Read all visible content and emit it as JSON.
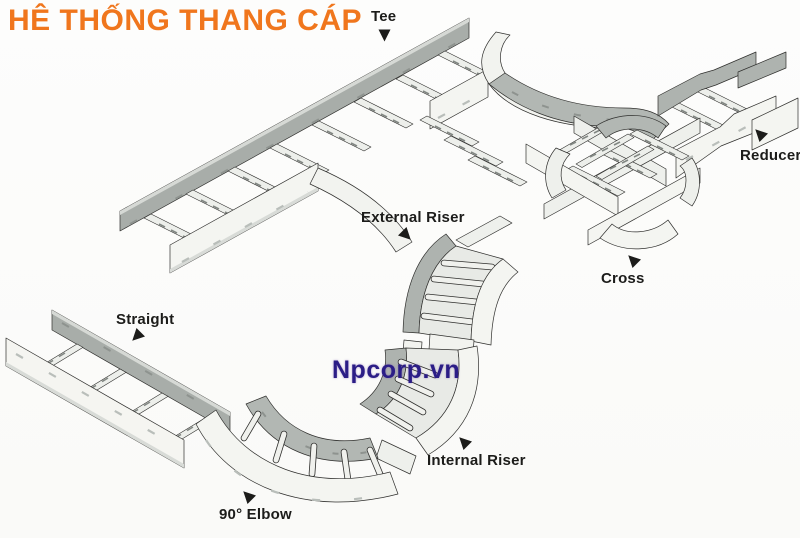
{
  "title": {
    "text": "HÊ THỐNG THANG CÁP"
  },
  "watermark": {
    "text": "Npcorp.vn"
  },
  "labels": {
    "tee": "Tee",
    "reducer": "Reducer",
    "external_riser": "External Riser",
    "cross": "Cross",
    "straight": "Straight",
    "internal_riser": "Internal Riser",
    "elbow_90": "90° Elbow"
  },
  "colors": {
    "title": "#f0761d",
    "watermark": "#2b1d86",
    "label_text": "#1c1c1a",
    "rail_dark": "#a8ada9",
    "rail_light": "#f4f5f1",
    "curve_gray": "#b2b7b3",
    "ladder_face": "#e8eae6",
    "outline": "#2f2f2d"
  }
}
